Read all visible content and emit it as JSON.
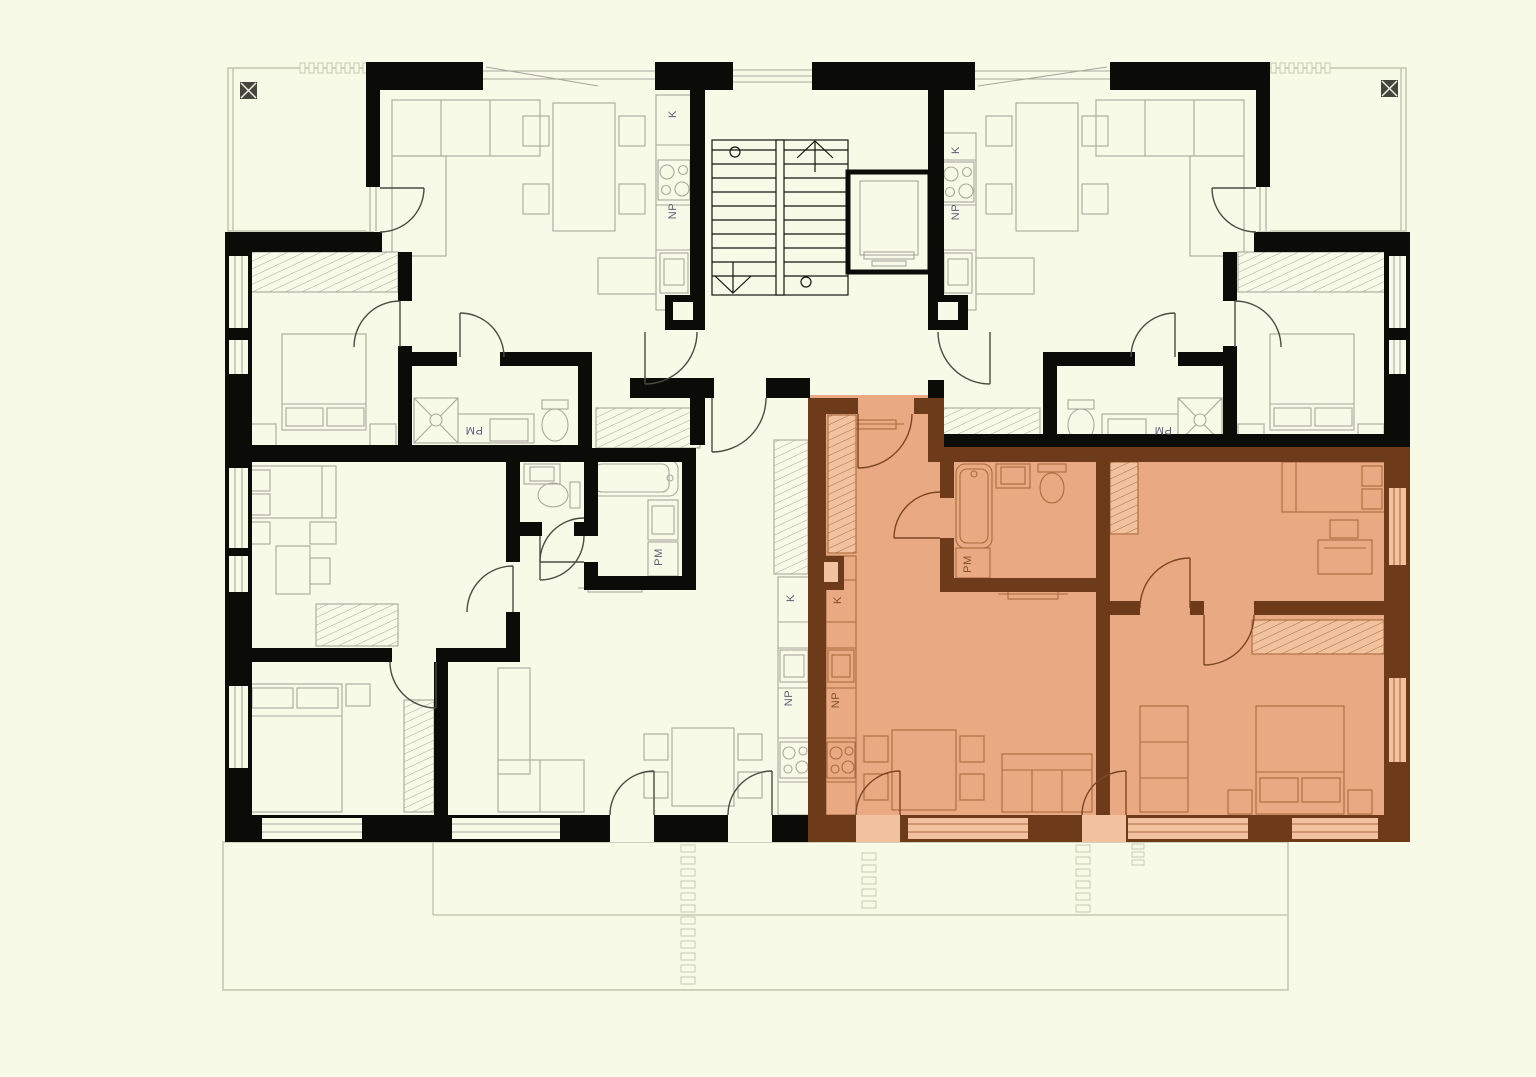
{
  "meta": {
    "drawing_type": "apartment building floor plan",
    "highlighted_unit": "bottom-right apartment (selected, shown in orange with brown walls)"
  },
  "colors": {
    "background": "#f8fae8",
    "wall": "#0b0b08",
    "furniture_line": "#a8a89c",
    "terrace_line": "#c6c9b2",
    "door_line": "#4b4b41",
    "label": "#5d5d76",
    "highlight_fill": "#e9aa83",
    "highlight_fill_light": "#f2c29e",
    "highlight_wall": "#6d3a1a",
    "highlight_furniture": "#a86b3e",
    "highlight_door": "#7a4624",
    "highlight_label": "#7d4e2c",
    "drain": "#45453d"
  },
  "fixture_label_meanings": {
    "K": "kitchen counter zone",
    "NP": "appliance zone",
    "PM": "washing machine zone"
  },
  "label_instances": [
    {
      "text": "K",
      "x": 676,
      "y": 114,
      "rot": -90,
      "theme": "gray"
    },
    {
      "text": "NP",
      "x": 676,
      "y": 211,
      "rot": -90,
      "theme": "gray"
    },
    {
      "text": "PM",
      "x": 474,
      "y": 427,
      "rot": 180,
      "theme": "gray"
    },
    {
      "text": "K",
      "x": 959,
      "y": 150,
      "rot": -90,
      "theme": "gray"
    },
    {
      "text": "NP",
      "x": 959,
      "y": 212,
      "rot": -90,
      "theme": "gray"
    },
    {
      "text": "PM",
      "x": 1163,
      "y": 427,
      "rot": 180,
      "theme": "gray"
    },
    {
      "text": "K",
      "x": 794,
      "y": 598,
      "rot": -90,
      "theme": "gray"
    },
    {
      "text": "NP",
      "x": 792,
      "y": 698,
      "rot": -90,
      "theme": "gray"
    },
    {
      "text": "PM",
      "x": 662,
      "y": 557,
      "rot": -90,
      "theme": "gray"
    },
    {
      "text": "K",
      "x": 841,
      "y": 600,
      "rot": -90,
      "theme": "brown"
    },
    {
      "text": "NP",
      "x": 839,
      "y": 700,
      "rot": -90,
      "theme": "brown"
    },
    {
      "text": "PM",
      "x": 971,
      "y": 564,
      "rot": -90,
      "theme": "brown"
    }
  ]
}
